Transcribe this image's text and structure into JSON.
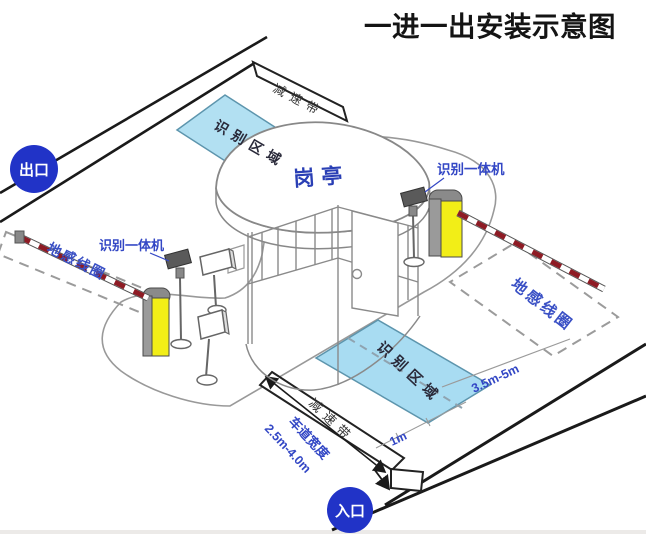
{
  "title": "一进一出安装示意图",
  "badges": {
    "exit": "出口",
    "entrance": "入口"
  },
  "booth": {
    "label": "岗亭"
  },
  "zones": {
    "recognition_exit": "识别区域",
    "recognition_entry": "识别区域",
    "ground_loop_exit": "地感线圈",
    "ground_loop_entry": "地感线圈"
  },
  "devices": {
    "reader_exit": "识别一体机",
    "reader_entry": "识别一体机"
  },
  "road": {
    "speed_bump_exit": "减速带",
    "speed_bump_entry": "减速带"
  },
  "measurements": {
    "loop_to_gate": "3.5m-5m",
    "recognition_depth": "1m",
    "lane_width_label": "车道宽度",
    "lane_width_value": "2.5m-4.0m"
  },
  "colors": {
    "label_blue": "#3347c5",
    "badge_blue": "#2133c7",
    "zone_fill": "#aadcf2",
    "zone_border": "#5d95ad",
    "barrier_yellow": "#f2ee17",
    "stripe_red": "#8e1b24",
    "line_black": "#1a1a1a",
    "outline_gray": "#888888"
  }
}
